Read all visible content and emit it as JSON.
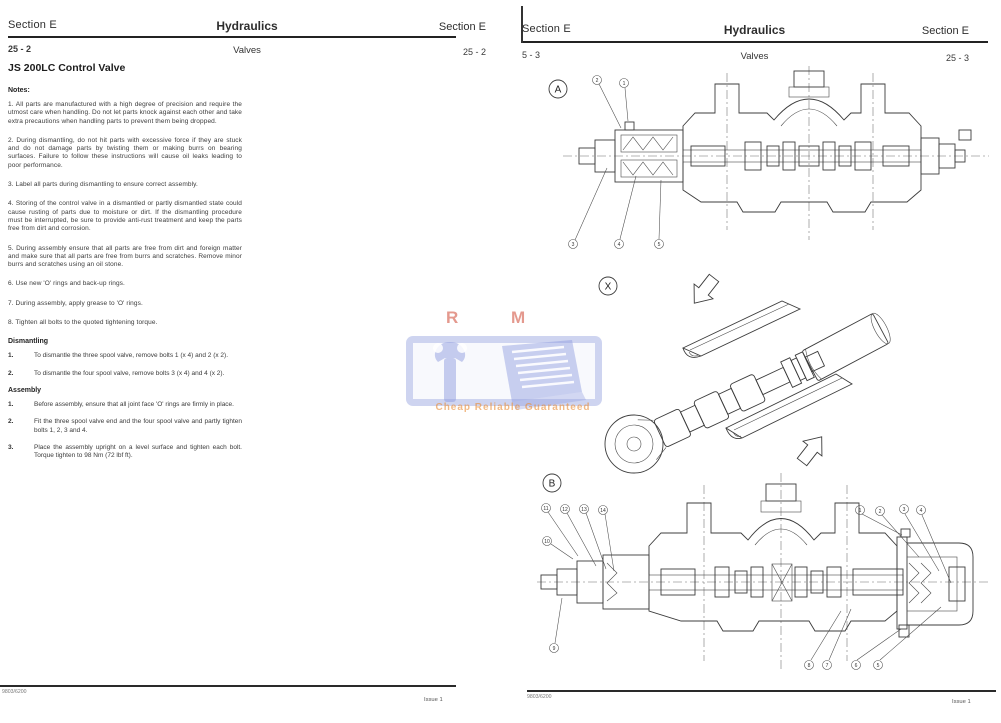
{
  "watermark": {
    "initials": "R M",
    "tagline": "Cheap Reliable Guaranteed",
    "accent_red": "#cd4632",
    "accent_orange": "#e88c37",
    "accent_blue": "#8c98de"
  },
  "left_page": {
    "header": {
      "section_left": "Section E",
      "title": "Hydraulics",
      "section_right": "Section E"
    },
    "page_row": {
      "page_left": "25 - 2",
      "subtitle": "Valves",
      "page_right": "25 - 2"
    },
    "title": "JS 200LC Control Valve",
    "notes_heading": "Notes:",
    "notes": [
      "1. All parts are manufactured with a high degree of precision and require the utmost care when handling. Do not let parts knock against each other and take extra precautions when handling parts to prevent them being dropped.",
      "2. During dismantling, do not hit parts with excessive force if they are stuck and do not damage parts by twisting them or making burrs on bearing surfaces. Failure to follow these instructions will cause oil leaks leading to poor performance.",
      "3. Label all parts during dismantling to ensure correct assembly.",
      "4. Storing of the control valve in a dismantled or partly dismantled state could cause rusting of parts due to moisture or dirt. If the dismantling procedure must be interrupted, be sure to provide anti-rust treatment and keep the parts free from dirt and corrosion.",
      "5. During assembly ensure that all parts are free from dirt and foreign matter and make sure that all parts are free from burrs and scratches. Remove minor burrs and scratches using an oil stone.",
      "6. Use new 'O' rings and back-up rings.",
      "7. During assembly, apply grease to 'O' rings.",
      "8. Tighten all bolts to the quoted tightening torque."
    ],
    "dismantling": {
      "heading": "Dismantling",
      "steps": [
        {
          "num": "1.",
          "text": "To dismantle the three spool valve, remove bolts 1 (x 4) and 2 (x 2)."
        },
        {
          "num": "2.",
          "text": "To dismantle the four spool valve, remove bolts 3 (x 4) and 4 (x 2)."
        }
      ]
    },
    "assembly": {
      "heading": "Assembly",
      "steps": [
        {
          "num": "1.",
          "text": "Before assembly, ensure that all joint face 'O' rings are firmly in place."
        },
        {
          "num": "2.",
          "text": "Fit the three spool valve end and the four spool valve and partly tighten bolts 1, 2, 3 and 4."
        },
        {
          "num": "3.",
          "text": "Place the assembly upright on a level surface and tighten each bolt. Torque tighten to 98 Nm (72 lbf ft)."
        }
      ]
    },
    "footer": {
      "code": "9803/6200",
      "issue": "Issue 1"
    }
  },
  "right_page": {
    "header": {
      "section_left": "Section E",
      "title": "Hydraulics",
      "section_right": "Section E"
    },
    "page_row": {
      "page_left": "5 - 3",
      "subtitle": "Valves",
      "page_right": "25 - 3"
    },
    "figures": {
      "a": {
        "label": "A",
        "callouts": [
          "2",
          "1",
          "3",
          "4",
          "5"
        ]
      },
      "x": {
        "label": "X"
      },
      "b": {
        "label": "B",
        "callouts_top_left": [
          "11",
          "12",
          "13",
          "14"
        ],
        "callout_left": "10",
        "callout_bottom_left": "9",
        "callouts_top_right": [
          "1",
          "2",
          "3",
          "4"
        ],
        "callouts_bottom_right": [
          "8",
          "7",
          "6",
          "5"
        ]
      }
    },
    "footer": {
      "code": "9803/6200",
      "issue": "Issue 1"
    }
  }
}
